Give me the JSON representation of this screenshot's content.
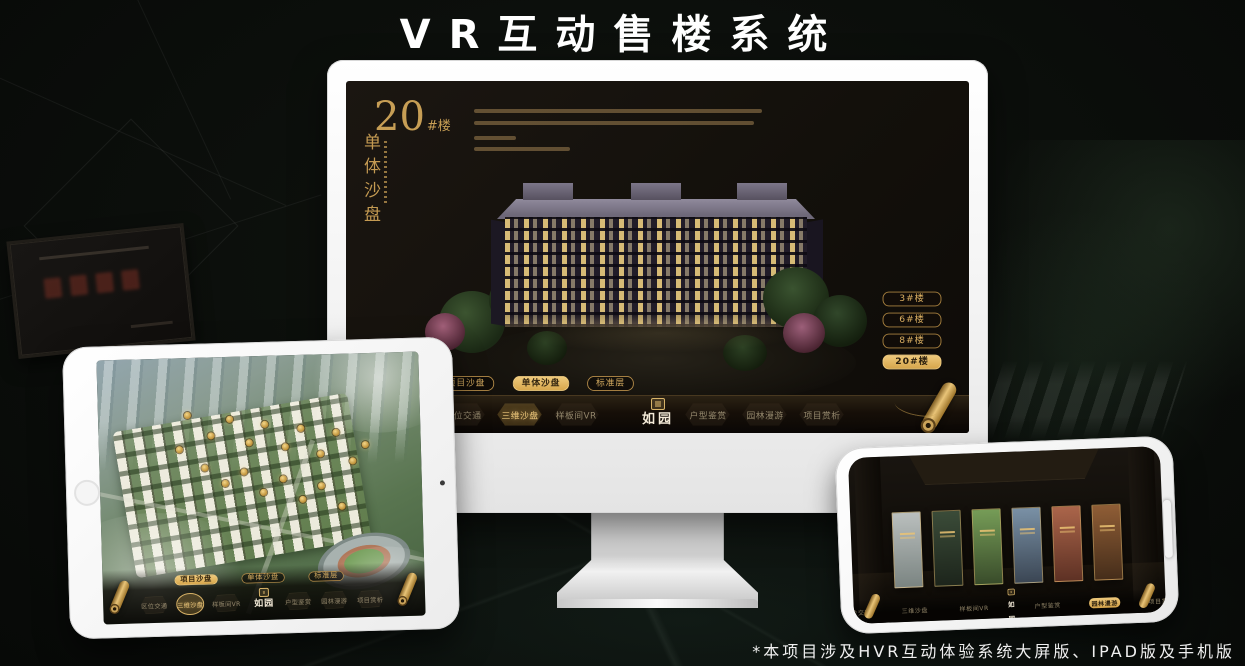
{
  "page": {
    "title": "VR互动售楼系统",
    "footnote": "*本项目涉及HVR互动体验系统大屏版、IPAD版及手机版"
  },
  "brand": {
    "name": "如园"
  },
  "colors": {
    "gold": "#cfa55e",
    "gold_bright": "#eec97c",
    "screen_bg": "#13100b"
  },
  "monitor_ui": {
    "block_number": "20",
    "block_suffix": "#楼",
    "block_subtitle": "单体沙盘",
    "floor_buttons": [
      {
        "label": "3#楼",
        "active": false
      },
      {
        "label": "6#楼",
        "active": false
      },
      {
        "label": "8#楼",
        "active": false
      },
      {
        "label": "20#楼",
        "active": true
      }
    ],
    "sub_tabs": [
      {
        "label": "项目沙盘",
        "active": false
      },
      {
        "label": "单体沙盘",
        "active": true
      },
      {
        "label": "标准层",
        "active": false
      }
    ],
    "nav_items": [
      {
        "label": "区位交通",
        "active": false
      },
      {
        "label": "三维沙盘",
        "active": true
      },
      {
        "label": "样板间VR",
        "active": false
      },
      {
        "label": "户型鉴赏",
        "active": false
      },
      {
        "label": "园林漫游",
        "active": false
      },
      {
        "label": "项目赏析",
        "active": false
      }
    ]
  },
  "ipad_ui": {
    "sub_tabs": [
      {
        "label": "项目沙盘",
        "active": true
      },
      {
        "label": "单体沙盘",
        "active": false
      },
      {
        "label": "标准层",
        "active": false
      }
    ],
    "nav_items": [
      {
        "label": "区位交通",
        "active": false
      },
      {
        "label": "三维沙盘",
        "active": true
      },
      {
        "label": "样板间VR",
        "active": false
      },
      {
        "label": "户型鉴赏",
        "active": false
      },
      {
        "label": "园林漫游",
        "active": false
      },
      {
        "label": "项目赏析",
        "active": false
      }
    ],
    "markers": [
      [
        28,
        22
      ],
      [
        35,
        30
      ],
      [
        41,
        24
      ],
      [
        47,
        33
      ],
      [
        52,
        26
      ],
      [
        58,
        35
      ],
      [
        63,
        28
      ],
      [
        69,
        38
      ],
      [
        74,
        30
      ],
      [
        79,
        41
      ],
      [
        33,
        42
      ],
      [
        39,
        48
      ],
      [
        45,
        44
      ],
      [
        51,
        52
      ],
      [
        57,
        47
      ],
      [
        63,
        55
      ],
      [
        69,
        50
      ],
      [
        75,
        58
      ],
      [
        25,
        35
      ],
      [
        83,
        35
      ]
    ]
  },
  "phone_ui": {
    "nav_items": [
      {
        "label": "区位交通",
        "active": false
      },
      {
        "label": "三维沙盘",
        "active": false
      },
      {
        "label": "样板间VR",
        "active": false
      },
      {
        "label": "户型鉴赏",
        "active": false
      },
      {
        "label": "园林漫游",
        "active": true
      },
      {
        "label": "项目赏析",
        "active": false
      }
    ],
    "panels": [
      {
        "tone": "#9fa6a4"
      },
      {
        "tone": "#2e3b2c"
      },
      {
        "tone": "#5c7a44"
      },
      {
        "tone": "#5f7183"
      },
      {
        "tone": "#8a4f3a"
      },
      {
        "tone": "#70492a"
      }
    ]
  }
}
